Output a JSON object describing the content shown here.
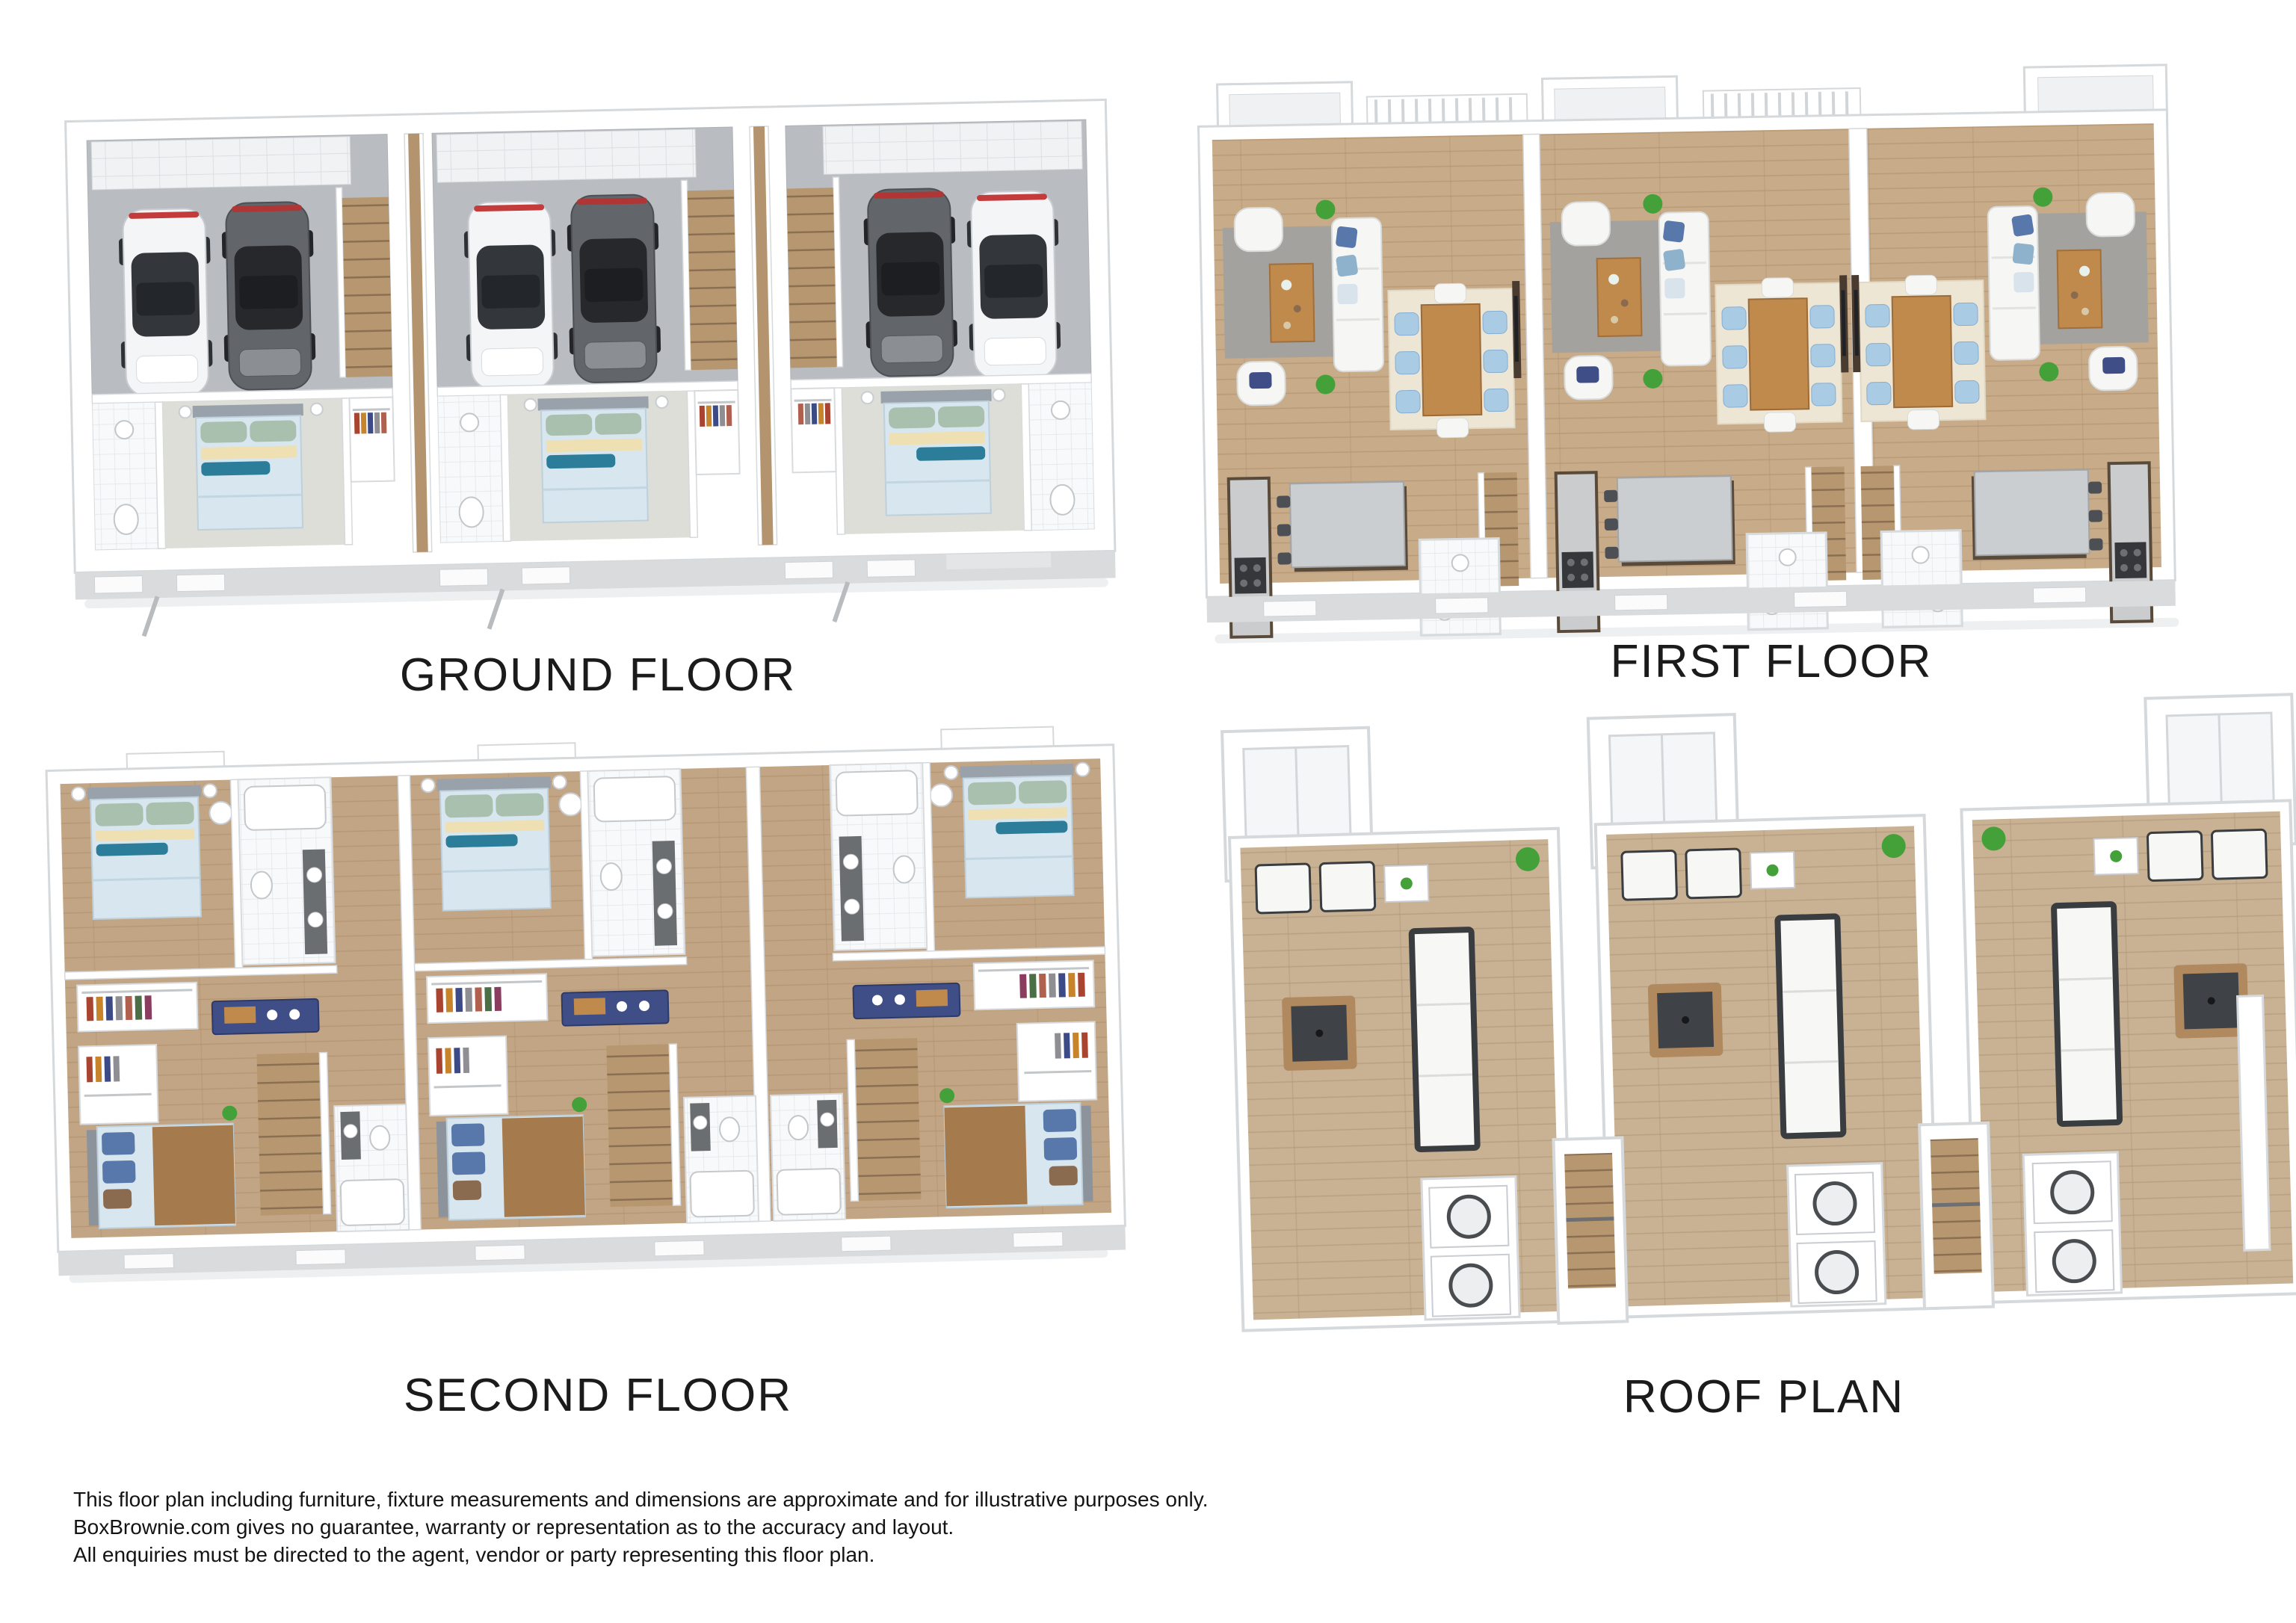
{
  "plans": [
    {
      "id": "ground-floor",
      "caption": "GROUND FLOOR"
    },
    {
      "id": "first-floor",
      "caption": "FIRST FLOOR"
    },
    {
      "id": "second-floor",
      "caption": "SECOND FLOOR"
    },
    {
      "id": "roof-plan",
      "caption": "ROOF PLAN"
    }
  ],
  "disclaimer": {
    "lines": [
      "This floor plan including furniture, fixture measurements and dimensions are approximate and for illustrative purposes only.",
      "BoxBrownie.com gives no guarantee, warranty or representation as to the accuracy and layout.",
      "All enquiries must be directed to the agent, vendor or party representing this floor plan."
    ]
  },
  "palette": {
    "wall": "#ffffff",
    "wall-line": "#d6d9dc",
    "facade": "#d9dbdd",
    "shadow": "#edeff0",
    "concrete": "#b9bcc0",
    "carpet": "#dcded7",
    "rug": "#a3a29e",
    "rug-cream": "#eee6d4",
    "wood-floor": "#c8ab89",
    "wood-dark": "#ab8c68",
    "deck-wood": "#c9b193",
    "deck-dark": "#ae9374",
    "stair-wood": "#b7976f",
    "hall-wood": "#b4946e",
    "bed-blue": "#d8e6ef",
    "teal": "#2b7d99",
    "pillow-green": "#a9c0af",
    "pillow-cream": "#eee0b2",
    "pillow-blue": "#5877ab",
    "navy": "#3f4e86",
    "chair-blue": "#a9cbe4",
    "tan": "#a57a4d",
    "table-wood": "#c08a4d",
    "granite": "#caced1",
    "cabinet": "#5a4a3a",
    "plant": "#44a038",
    "glass": "#33363b",
    "car-white": "#f4f5f6",
    "car-dark": "#62656a",
    "text": "#1b1b1b"
  }
}
